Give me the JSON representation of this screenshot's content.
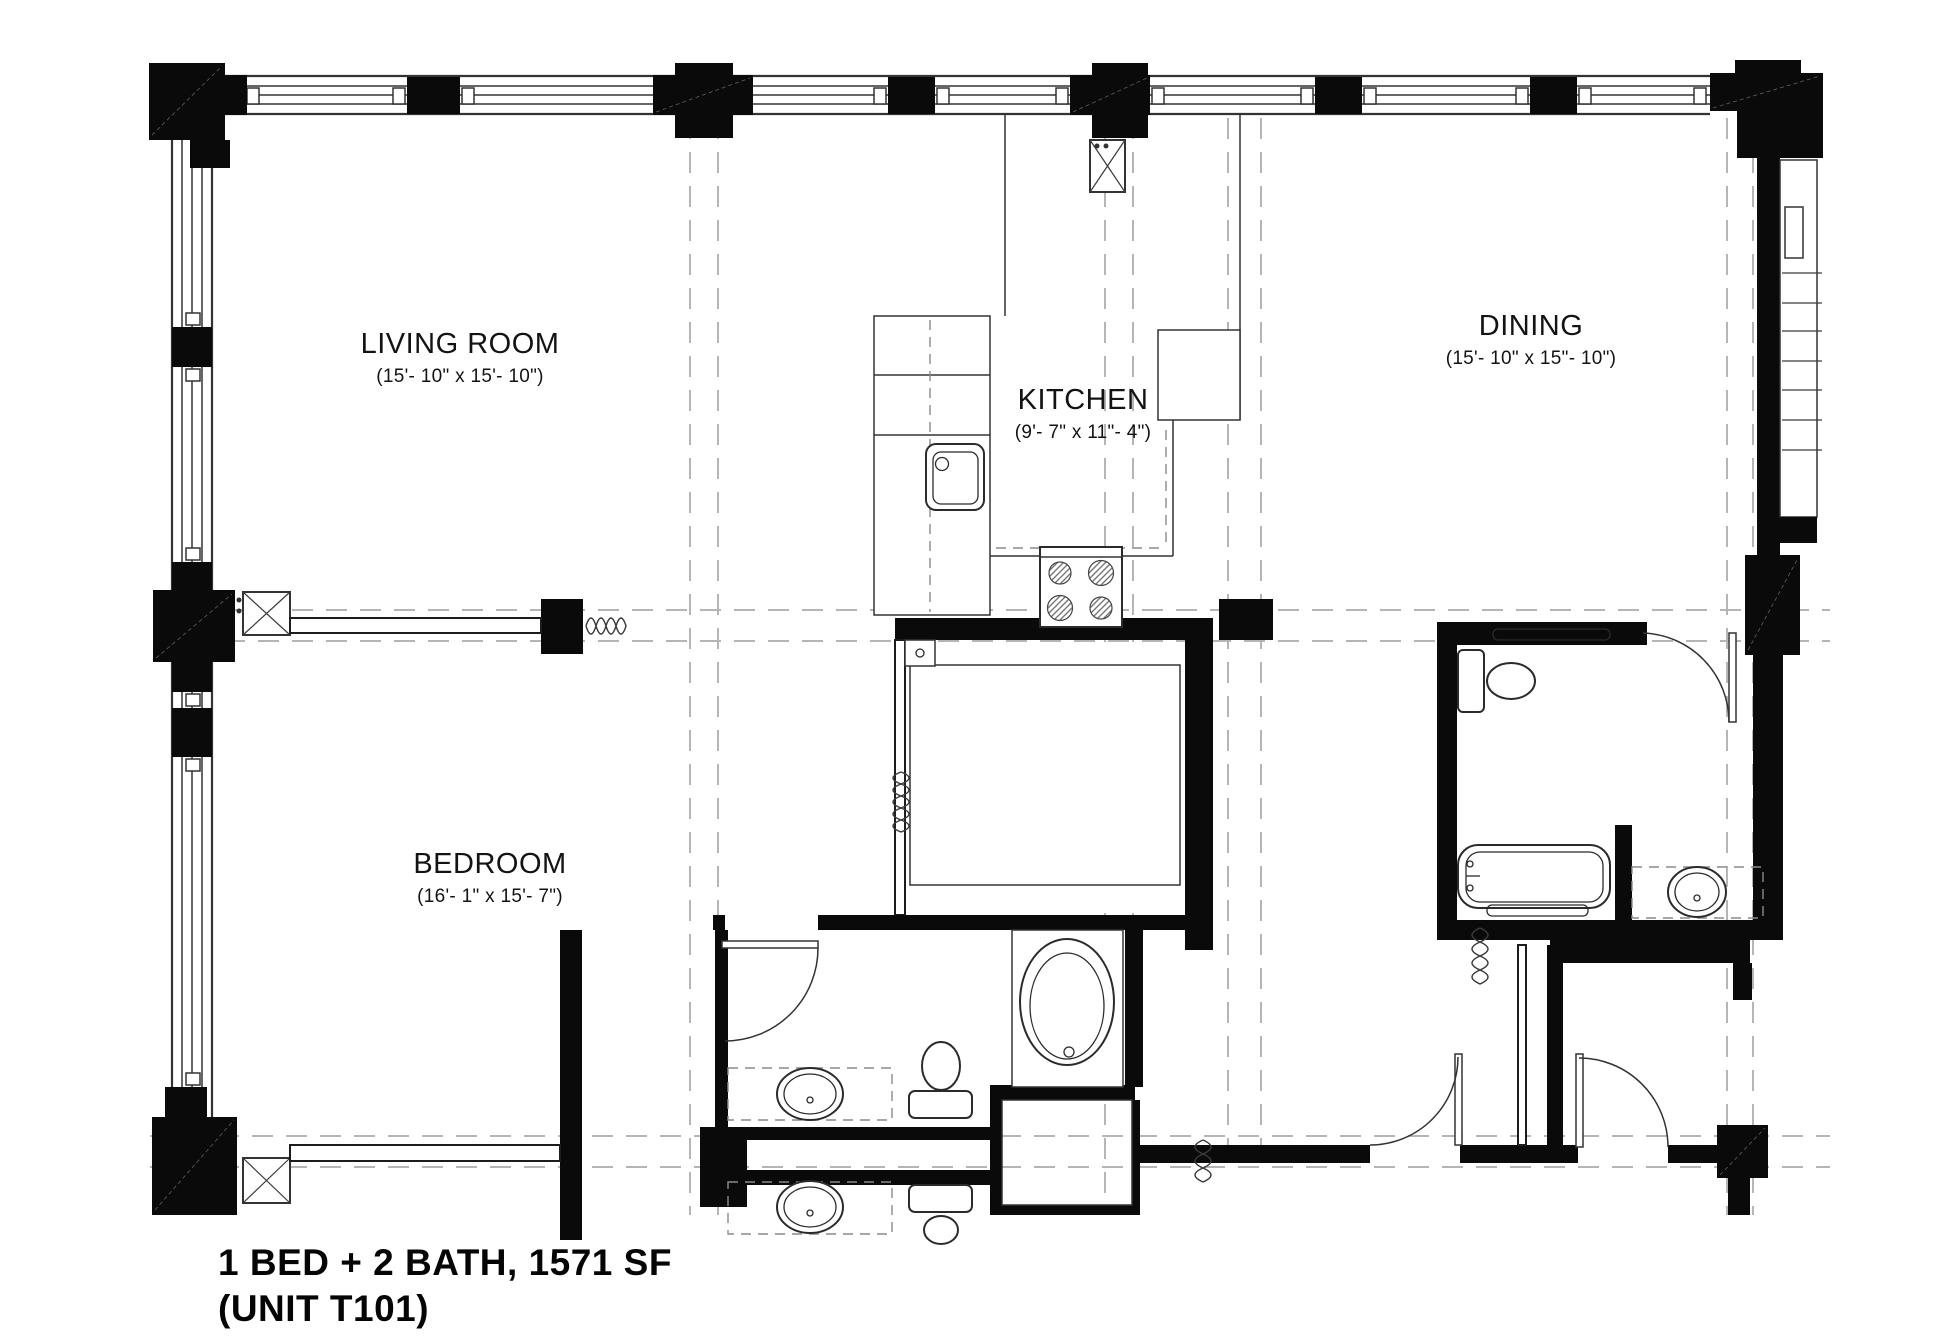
{
  "title": {
    "line1": "1 BED + 2 BATH, 1571 SF",
    "line2": "(UNIT T101)"
  },
  "rooms": {
    "living_room": {
      "name": "LIVING ROOM",
      "dims": "(15'- 10\" x 15'- 10\")"
    },
    "kitchen": {
      "name": "KITCHEN",
      "dims": "(9'- 7\" x 11\"- 4\")"
    },
    "dining": {
      "name": "DINING",
      "dims": "(15'- 10\" x 15\"- 10\")"
    },
    "bedroom": {
      "name": "BEDROOM",
      "dims": "(16'- 1\" x 15'- 7\")"
    }
  },
  "colors": {
    "wall": "#0a0a0a",
    "line": "#333333",
    "grid": "#b5b5b5",
    "paper": "#ffffff",
    "ink": "#111111"
  }
}
